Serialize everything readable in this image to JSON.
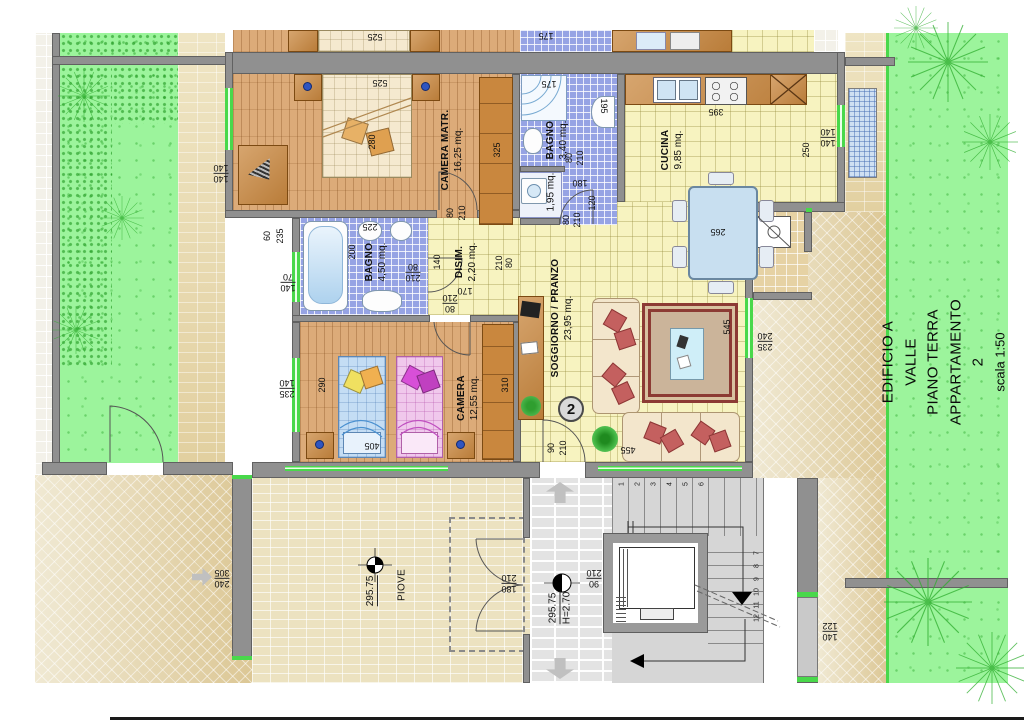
{
  "title_block": {
    "building": "EDIFICIO A VALLE",
    "floor": "PIANO TERRA",
    "unit": "APPARTAMENTO 2",
    "scale": "scala 1:50"
  },
  "apartment_badge": "2",
  "rooms": {
    "camera_matr": {
      "name": "CAMERA MATR.",
      "area": "16,25 mq."
    },
    "bagno_grande": {
      "name": "BAGNO",
      "area": "4,50 mq."
    },
    "bagno_piccolo": {
      "name": "BAGNO",
      "area": "3,40 mq."
    },
    "lavanderia": {
      "area": "1,95 mq."
    },
    "disimpegno": {
      "name": "DISIM.",
      "area": "2,20 mq."
    },
    "cucina": {
      "name": "CUCINA",
      "area": "9,85 mq."
    },
    "soggiorno": {
      "name": "SOGGIORNO / PRANZO",
      "area": "23,95 mq."
    },
    "camera": {
      "name": "CAMERA",
      "area": "12,55 mq."
    },
    "esterno": {
      "piove": "PIOVE"
    }
  },
  "levels": {
    "patio_quota": "295.75",
    "vano_scala_quota": "295.75",
    "altezza": "H=2.70"
  },
  "dims": {
    "525": "525",
    "280": "280",
    "325": "325",
    "175": "175",
    "195": "195",
    "140": "140",
    "70": "70",
    "60": "60",
    "235": "235",
    "225": "225",
    "200": "200",
    "210": "210",
    "80": "80",
    "170": "170",
    "120": "120",
    "180": "180",
    "395": "395",
    "265": "265",
    "250": "250",
    "455": "455",
    "545": "545",
    "240": "240",
    "90": "90",
    "290": "290",
    "405": "405",
    "310": "310",
    "305": "305",
    "122": "122"
  },
  "stairs": {
    "flight_up": [
      "1",
      "2",
      "3",
      "4",
      "5",
      "6"
    ],
    "flight_down": [
      "7",
      "8",
      "9",
      "10",
      "11",
      "12"
    ]
  },
  "colors": {
    "wall": "#909090",
    "garden": "#9cf49c",
    "garden_edge": "#49d84b",
    "wood_floor": "#dcab79",
    "bath_tile": "#96a3e4",
    "living_floor": "#f7f3c0",
    "paving": "#ece2c0",
    "carpet_border": "#8c3b34",
    "sofa_cushion": "#c4605f"
  }
}
